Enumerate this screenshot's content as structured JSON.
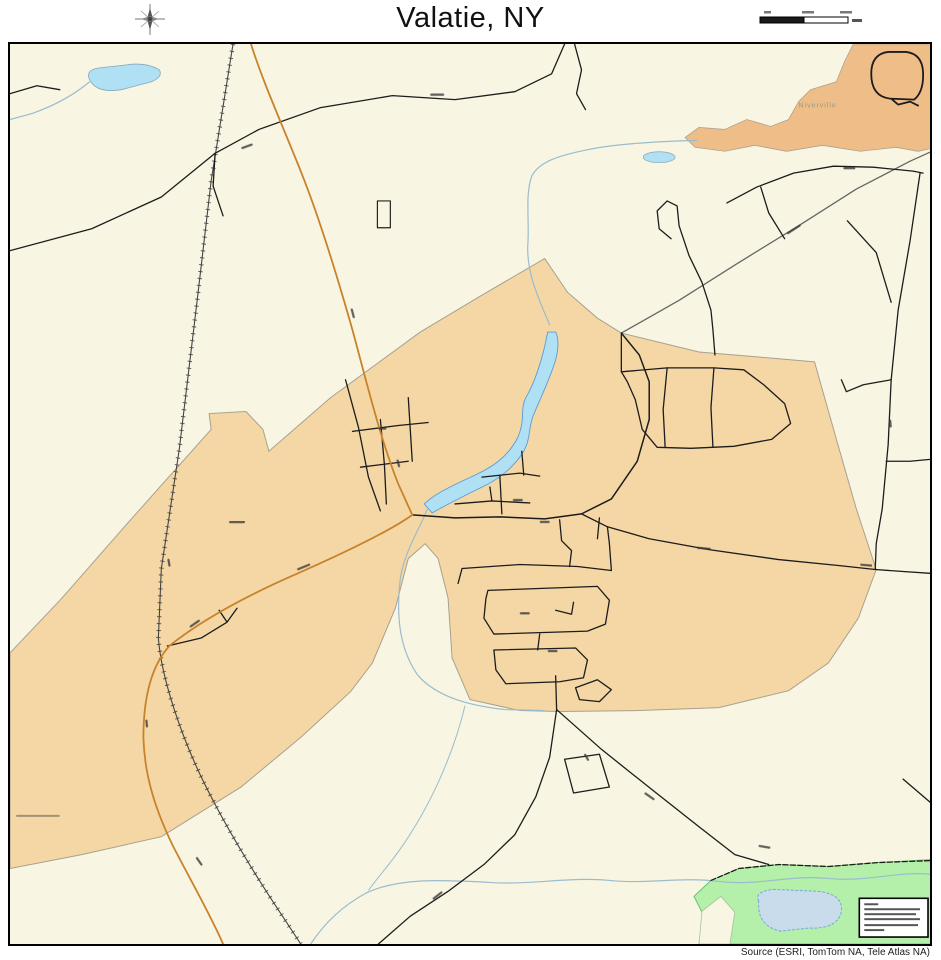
{
  "header": {
    "title": "Valatie, NY",
    "compass_icon": "compass-rose",
    "scale_bar": {
      "segments": 2,
      "labels_illegible": true
    }
  },
  "footer": {
    "source": "Source (ESRI, TomTom NA, Tele Atlas NA)"
  },
  "map": {
    "labels": {
      "hamlet_top_right": "Niverville"
    },
    "features": {
      "village_boundary": "Valatie village area (tan polygon)",
      "hamlet_area": "Niverville area (orange polygon, top right)",
      "park_area": "green park area with pond (bottom right)",
      "creek": "blue creek ribbon through village center",
      "lake_top_left": "small pond",
      "railroad": "diagonal railroad with cross ticks",
      "legend_box_lines": 6,
      "road_labels_illegible": true
    },
    "colors": {
      "background": "#f8f5e2",
      "village_fill": "#f4d7a5",
      "hamlet_fill": "#efbe88",
      "park_fill": "#b4f0aa",
      "water_fill": "#b0e0f4",
      "pond_fill": "#c9dcec",
      "road_black": "#1c1c1c",
      "road_orange": "#c8832a",
      "stream": "#9bbccc"
    }
  }
}
